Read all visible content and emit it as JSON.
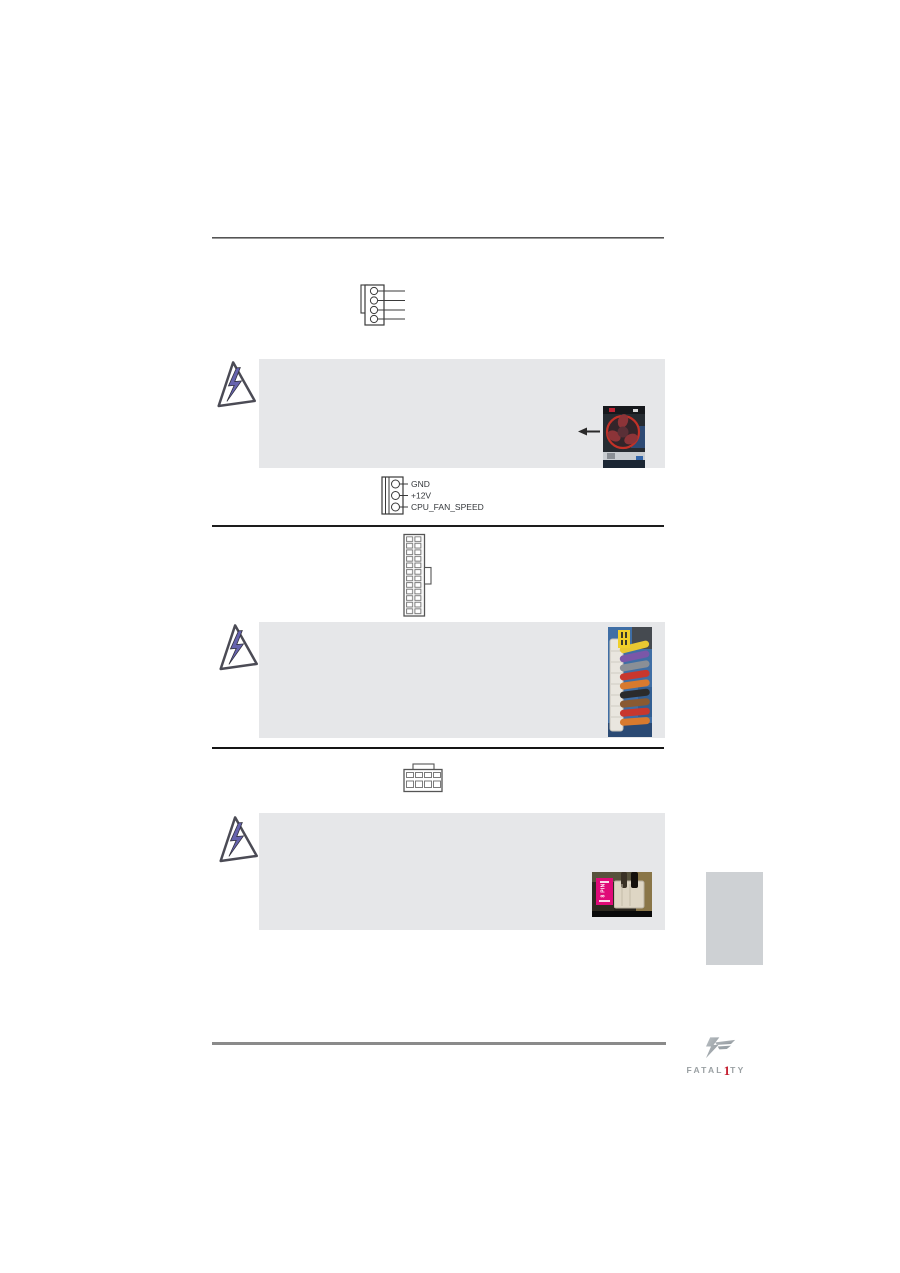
{
  "page": {
    "type": "motherboard-manual-page"
  },
  "cpu_fan_connector": {
    "pin_labels": [
      "GND",
      "+12V",
      "CPU_FAN_SPEED"
    ]
  },
  "power_photo": {
    "label_main": "8 PIN"
  },
  "logo": {
    "part1": "FATAL",
    "digit": "1",
    "part2": "TY"
  },
  "icons": {
    "warning": "warning-lightning-triangle",
    "arrow": "left-arrow",
    "fan_connector_4pin": "fan-connector-4pin-diagram",
    "fan_connector_3pin": "fan-connector-3pin-diagram",
    "atx_24pin": "atx-24pin-power-connector-diagram",
    "atx_8pin": "atx-8pin-12v-connector-diagram"
  },
  "colors": {
    "note_box_bg": "#e6e7e9",
    "divider_top": "#545454",
    "divider_mid": "#1d1d1d",
    "divider_bottom": "#8a8a8a",
    "warning_bolt": "#6663ae",
    "side_tab": "#ced1d4",
    "photo_label_yellow": "#f0d02a",
    "photo_label_magenta": "#e00a78",
    "logo_gray": "#9aa0a3",
    "logo_red": "#c42030"
  }
}
